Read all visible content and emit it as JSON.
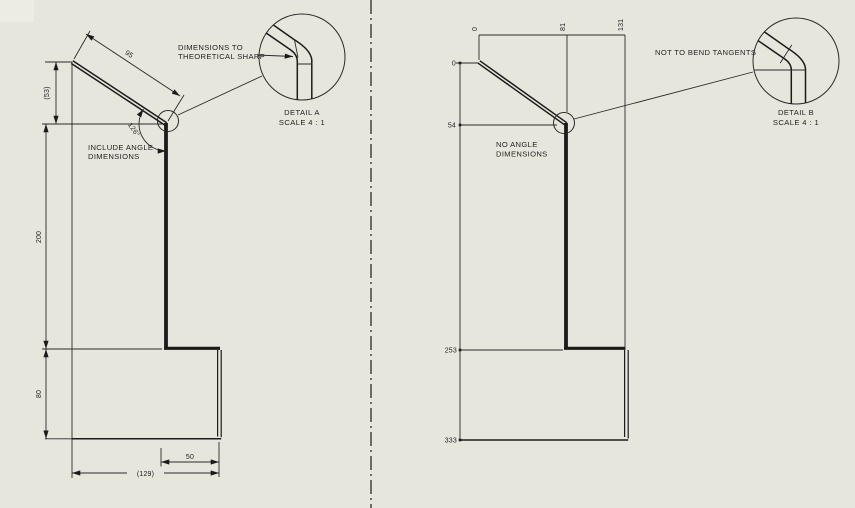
{
  "colors": {
    "background": "#e7e6dd",
    "line": "#1b1b1b",
    "text": "#1f1f1f"
  },
  "left_view": {
    "callout": {
      "line1": "DIMENSIONS TO",
      "line2": "THEORETICAL SHARP"
    },
    "note": {
      "line1": "INCLUDE ANGLE",
      "line2": "DIMENSIONS"
    },
    "detail": {
      "title": "DETAIL A",
      "scale": "SCALE 4 : 1"
    },
    "dimensions": {
      "flange_length": "95",
      "flange_height_ref": "(53)",
      "web_height": "200",
      "base_height": "80",
      "flange_width": "50",
      "overall_width": "(129)",
      "bend_angle": "126°"
    }
  },
  "right_view": {
    "callout": "NOT TO BEND TANGENTS",
    "note": {
      "line1": "NO ANGLE",
      "line2": "DIMENSIONS"
    },
    "detail": {
      "title": "DETAIL B",
      "scale": "SCALE 4 : 1"
    },
    "ordinates_horizontal": [
      "0",
      "81",
      "131"
    ],
    "ordinates_vertical": [
      "0",
      "54",
      "253",
      "333"
    ]
  }
}
